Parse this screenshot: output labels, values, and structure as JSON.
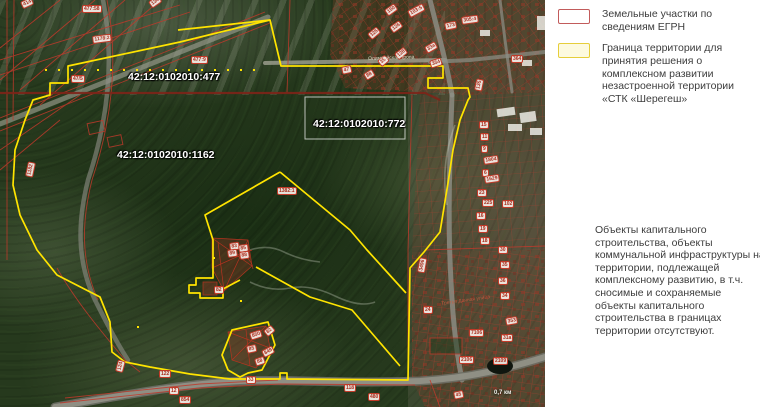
{
  "legend": {
    "items": [
      {
        "label": "Земельные участки по сведениям ЕГРН",
        "swatch_border": "#c25b5b",
        "swatch_fill": "#ffffff"
      },
      {
        "label": "Граница территории для принятия решения о комплексном развитии незастроенной территории «СТК «Шерегеш»",
        "swatch_border": "#e6ce3a",
        "swatch_fill": "#fdfadf"
      }
    ],
    "note": "Объекты капитального строительства, объекты коммунальной инфраструктуры на территории, подлежащей комплексному развитию, в т.ч. сносимые и сохраняемые объекты капитального строительства в границах территории отсутствуют."
  },
  "map": {
    "cadastral_labels": [
      {
        "text": "42:12:0102010:477",
        "x": 128,
        "y": 72
      },
      {
        "text": "42:12:0102010:1162",
        "x": 117,
        "y": 150
      },
      {
        "text": "42:12:0102010:772",
        "x": 313,
        "y": 119
      }
    ],
    "road_labels": [
      {
        "text": "Олимпийская тропа",
        "x": 368,
        "y": 56,
        "rot": -2,
        "kind": "trail"
      },
      {
        "text": "Третья Дачная улица",
        "x": 441,
        "y": 301,
        "rot": -8,
        "kind": "street"
      }
    ],
    "scale_label": {
      "text": "0,7 км",
      "x": 494,
      "y": 390
    },
    "parcel_chips": [
      {
        "t": "414",
        "x": 20,
        "y": 2,
        "r": -25
      },
      {
        "t": "134",
        "x": 148,
        "y": 2,
        "r": -35
      },
      {
        "t": "477:58",
        "x": 82,
        "y": 5,
        "r": 0
      },
      {
        "t": "1178:2",
        "x": 92,
        "y": 36,
        "r": -7
      },
      {
        "t": "47/5",
        "x": 71,
        "y": 75,
        "r": 0
      },
      {
        "t": "477:9",
        "x": 191,
        "y": 56,
        "r": 0
      },
      {
        "t": "1182",
        "x": 25,
        "y": 176,
        "r": -78
      },
      {
        "t": "305:4",
        "x": 461,
        "y": 17,
        "r": -8
      },
      {
        "t": "173",
        "x": 444,
        "y": 23,
        "r": -12
      },
      {
        "t": "103:5",
        "x": 407,
        "y": 11,
        "r": -28
      },
      {
        "t": "150",
        "x": 384,
        "y": 10,
        "r": -35
      },
      {
        "t": "126",
        "x": 389,
        "y": 27,
        "r": -35
      },
      {
        "t": "125",
        "x": 367,
        "y": 34,
        "r": -40
      },
      {
        "t": "33а",
        "x": 424,
        "y": 47,
        "r": -30
      },
      {
        "t": "128",
        "x": 394,
        "y": 54,
        "r": -38
      },
      {
        "t": "35",
        "x": 377,
        "y": 61,
        "r": -40
      },
      {
        "t": "354",
        "x": 429,
        "y": 61,
        "r": -18
      },
      {
        "t": "47",
        "x": 341,
        "y": 67,
        "r": -12
      },
      {
        "t": "88",
        "x": 363,
        "y": 74,
        "r": -32
      },
      {
        "t": "364",
        "x": 511,
        "y": 55,
        "r": 0
      },
      {
        "t": "135",
        "x": 474,
        "y": 90,
        "r": -78
      },
      {
        "t": "15",
        "x": 479,
        "y": 121,
        "r": 0
      },
      {
        "t": "11",
        "x": 480,
        "y": 133,
        "r": 0
      },
      {
        "t": "9",
        "x": 481,
        "y": 145,
        "r": 0
      },
      {
        "t": "1804",
        "x": 483,
        "y": 157,
        "r": -8
      },
      {
        "t": "6",
        "x": 482,
        "y": 169,
        "r": 0
      },
      {
        "t": "1629",
        "x": 484,
        "y": 176,
        "r": -8
      },
      {
        "t": "23",
        "x": 477,
        "y": 189,
        "r": 0
      },
      {
        "t": "225",
        "x": 482,
        "y": 199,
        "r": 0
      },
      {
        "t": "16",
        "x": 476,
        "y": 212,
        "r": 0
      },
      {
        "t": "19",
        "x": 478,
        "y": 225,
        "r": 0
      },
      {
        "t": "18",
        "x": 480,
        "y": 237,
        "r": 0
      },
      {
        "t": "102",
        "x": 502,
        "y": 200,
        "r": 0
      },
      {
        "t": "30",
        "x": 498,
        "y": 246,
        "r": 0
      },
      {
        "t": "35",
        "x": 500,
        "y": 261,
        "r": 0
      },
      {
        "t": "36",
        "x": 498,
        "y": 277,
        "r": 0
      },
      {
        "t": "34",
        "x": 500,
        "y": 292,
        "r": 0
      },
      {
        "t": "353",
        "x": 505,
        "y": 318,
        "r": -10
      },
      {
        "t": "31а",
        "x": 501,
        "y": 334,
        "r": 0
      },
      {
        "t": "3496",
        "x": 417,
        "y": 272,
        "r": -80
      },
      {
        "t": "24",
        "x": 423,
        "y": 306,
        "r": 0
      },
      {
        "t": "7106",
        "x": 469,
        "y": 329,
        "r": 0
      },
      {
        "t": "2106",
        "x": 459,
        "y": 356,
        "r": 0
      },
      {
        "t": "2109",
        "x": 493,
        "y": 357,
        "r": 0
      },
      {
        "t": "45",
        "x": 453,
        "y": 392,
        "r": -12
      },
      {
        "t": "480",
        "x": 368,
        "y": 393,
        "r": 0
      },
      {
        "t": "118",
        "x": 344,
        "y": 384,
        "r": 0
      },
      {
        "t": "33",
        "x": 246,
        "y": 376,
        "r": 0
      },
      {
        "t": "122",
        "x": 159,
        "y": 370,
        "r": 0
      },
      {
        "t": "12",
        "x": 169,
        "y": 387,
        "r": 0
      },
      {
        "t": "854",
        "x": 179,
        "y": 396,
        "r": 0
      },
      {
        "t": "124",
        "x": 115,
        "y": 371,
        "r": -75
      },
      {
        "t": "1382:1",
        "x": 277,
        "y": 187,
        "r": 0
      },
      {
        "t": "83",
        "x": 229,
        "y": 243,
        "r": -8
      },
      {
        "t": "85",
        "x": 238,
        "y": 245,
        "r": -8
      },
      {
        "t": "89",
        "x": 227,
        "y": 250,
        "r": -8
      },
      {
        "t": "88",
        "x": 239,
        "y": 252,
        "r": -8
      },
      {
        "t": "82",
        "x": 214,
        "y": 286,
        "r": 0
      },
      {
        "t": "850",
        "x": 249,
        "y": 333,
        "r": -18
      },
      {
        "t": "82",
        "x": 263,
        "y": 331,
        "r": -40
      },
      {
        "t": "85",
        "x": 246,
        "y": 346,
        "r": -12
      },
      {
        "t": "849",
        "x": 261,
        "y": 351,
        "r": -28
      },
      {
        "t": "88",
        "x": 254,
        "y": 359,
        "r": -18
      }
    ],
    "colors": {
      "boundary_yellow": "#ffe400",
      "parcel_red": "#c0392b",
      "dark_red_road": "#7e2318",
      "callout_white": "rgba(255,255,255,0.7)",
      "forest_green": "#26391d"
    }
  }
}
